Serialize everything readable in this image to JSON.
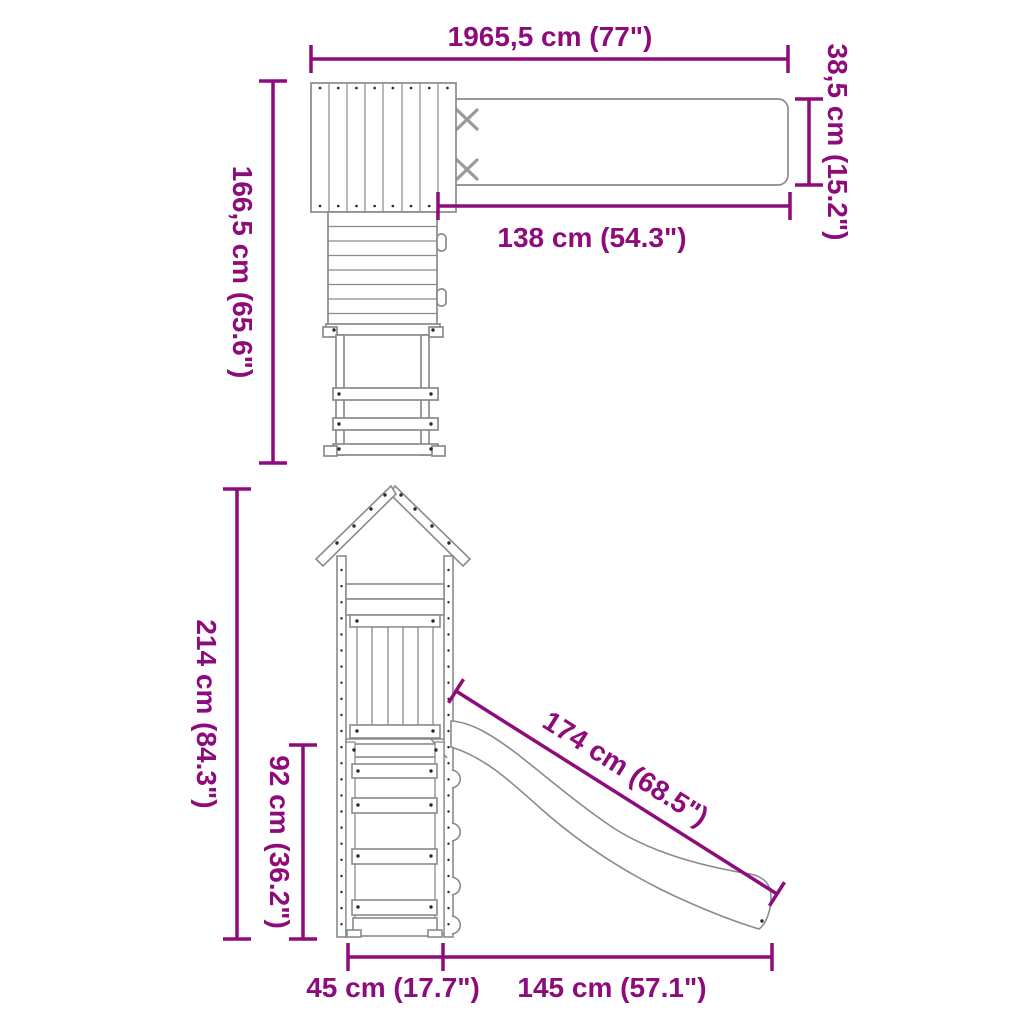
{
  "title": "playset-dimension-diagram",
  "colors": {
    "dimension": "#8d0b7a",
    "outline": "#8a8a8a",
    "outline_light": "#9a9a9a",
    "detail": "#2a2a2a",
    "background": "#ffffff"
  },
  "plan_view": {
    "dims": {
      "total_width": "1965,5 cm (77\")",
      "tower_depth": "166,5 cm (65.6\")",
      "beam_length": "138 cm (54.3\")",
      "beam_width": "38,5 cm (15.2\")"
    }
  },
  "side_view": {
    "dims": {
      "total_height": "214 cm (84.3\")",
      "platform_height": "92 cm (36.2\")",
      "slide_length": "174 cm (68.5\")",
      "base_depth": "45 cm (17.7\")",
      "slide_run": "145 cm (57.1\")"
    }
  }
}
